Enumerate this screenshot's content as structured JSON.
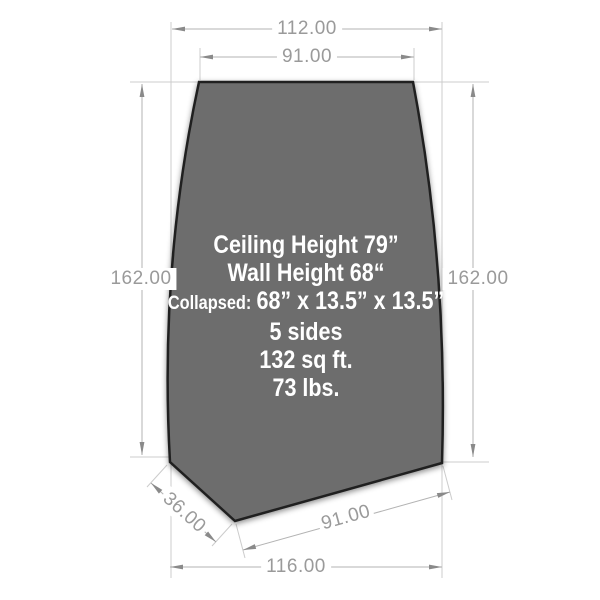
{
  "diagram": {
    "dimensions": {
      "top_outer": "112.00",
      "top_inner": "91.00",
      "left_height": "162.00",
      "right_height": "162.00",
      "bottom_angled": "36.00",
      "bottom_inner": "91.00",
      "bottom_outer": "116.00"
    },
    "specs": {
      "ceiling_height": "Ceiling Height 79”",
      "wall_height": "Wall Height 68“",
      "collapsed_label": "Collapsed:",
      "collapsed_value": "68” x 13.5” x 13.5”",
      "sides": "5 sides",
      "area": "132 sq ft.",
      "weight": "73 lbs."
    },
    "colors": {
      "panel_fill": "#6d6d6d",
      "panel_outline": "#202020",
      "dimension_text": "#9a9a9a",
      "dimension_line": "#b3b3b3",
      "extension_line": "#cccccc",
      "spec_text": "#ffffff",
      "background": "#ffffff"
    }
  }
}
